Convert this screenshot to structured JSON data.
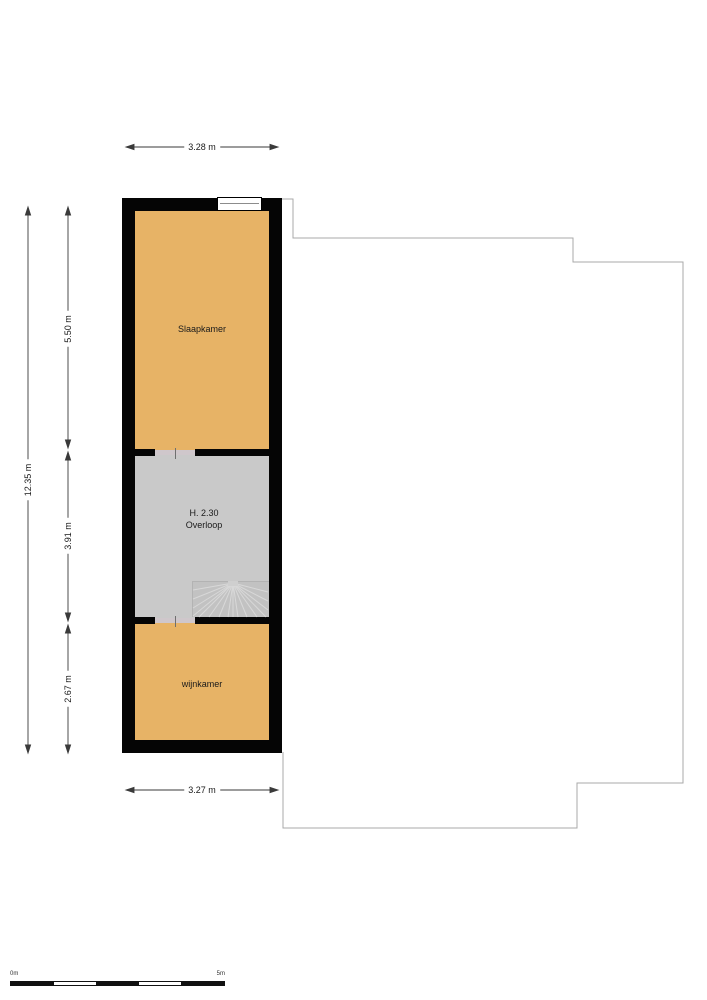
{
  "plan": {
    "rooms": {
      "slaapkamer": {
        "label": "Slaapkamer"
      },
      "overloop": {
        "height_label": "H. 2.30",
        "label": "Overloop"
      },
      "wijnkamer": {
        "label": "wijnkamer"
      }
    },
    "dimensions": {
      "top_width": "3.28 m",
      "bottom_width": "3.27 m",
      "total_height": "12.35 m",
      "slaapkamer_height": "5.50 m",
      "overloop_height": "3.91 m",
      "wijnkamer_height": "2.67 m"
    },
    "scale_bar": {
      "start": "0m",
      "end": "5m"
    },
    "colors": {
      "room_fill": "#e7b366",
      "hall_fill": "#c9c9c9",
      "stairs_fill": "#c2c2c2",
      "wall": "#050505",
      "context_outline": "#a9a9a9",
      "dimension_line": "#3a3a3a"
    }
  }
}
